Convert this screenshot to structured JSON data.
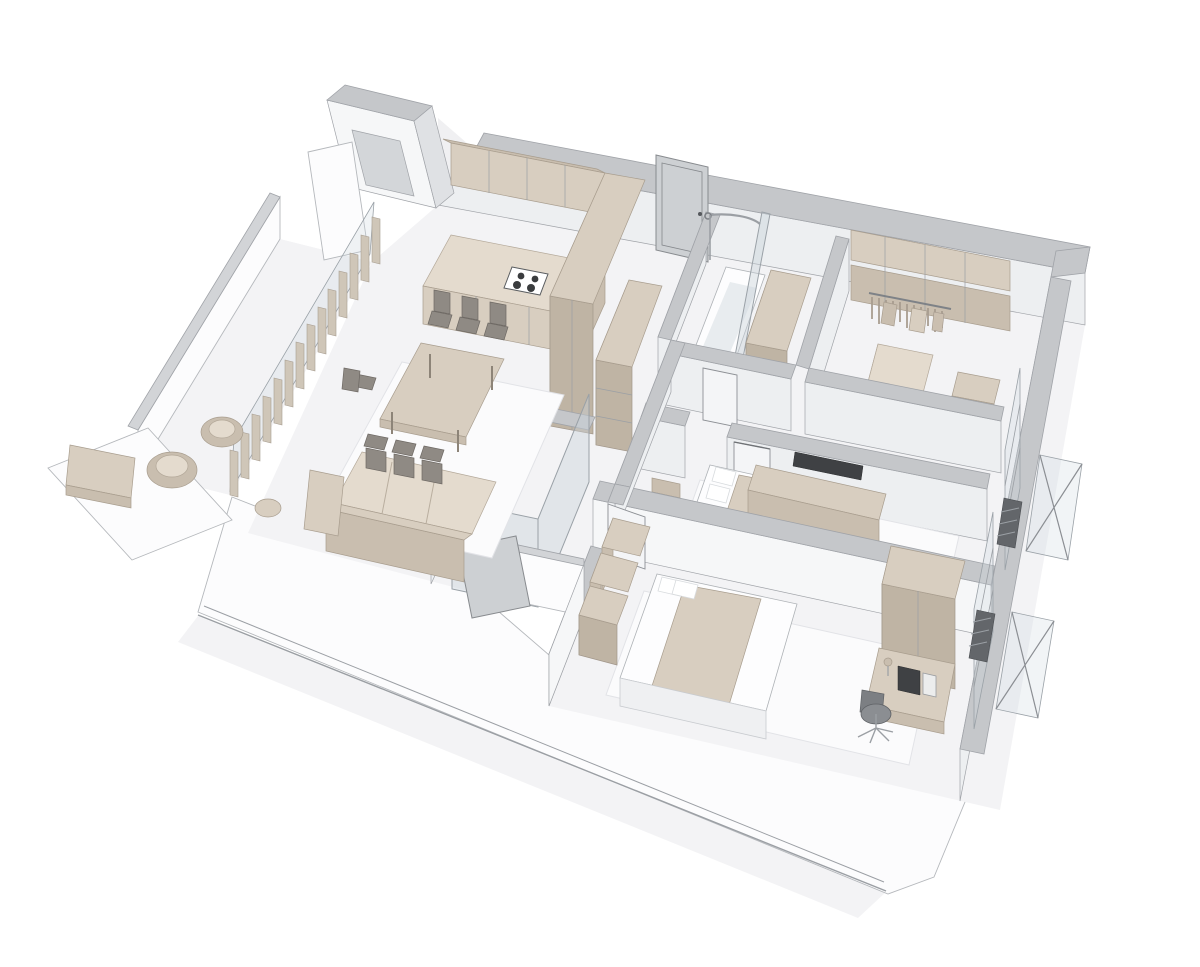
{
  "scene": {
    "description": "3D cutaway isometric rendering of a two-bedroom apartment floor plan, grayscale walls with beige furniture, no visible text",
    "type": "architectural-3d-floor-plan",
    "background": "#ffffff",
    "rooms": [
      {
        "name": "living-room",
        "furniture": [
          "corner-sofa",
          "dining-table",
          "six-dining-chairs",
          "side-table",
          "white-rug"
        ]
      },
      {
        "name": "kitchen",
        "furniture": [
          "l-shaped-counter",
          "cooktop-four-burners",
          "upper-cabinets",
          "tall-cabinet-column",
          "open-shelving-unit"
        ]
      },
      {
        "name": "balcony-left",
        "furniture": [
          "round-lounge-chair",
          "round-lounge-chair",
          "coffee-table",
          "vertical-slat-blinds",
          "glazing",
          "parapet-wall"
        ]
      },
      {
        "name": "entrance-hall",
        "furniture": [
          "tall-entrance-door",
          "open-vestibule-door",
          "corridor-walls"
        ]
      },
      {
        "name": "guest-wc",
        "furniture": [
          "glass-shower-enclosure",
          "toilet"
        ]
      },
      {
        "name": "bathroom",
        "furniture": [
          "bathtub",
          "curved-shower-rod",
          "glass-screen",
          "washer-storage-column",
          "white-door"
        ]
      },
      {
        "name": "walk-in-closet",
        "furniture": [
          "clothes-rail-with-hangers",
          "shelving-bands",
          "island-drawer-unit",
          "bench"
        ]
      },
      {
        "name": "bedroom-1",
        "furniture": [
          "double-bed",
          "pillows",
          "beige-blanket",
          "wall-tv",
          "tv-console",
          "armchair",
          "white-door",
          "white-rug"
        ]
      },
      {
        "name": "bedroom-2",
        "furniture": [
          "double-bed",
          "pillows",
          "beige-blanket",
          "wardrobe-cube-stack",
          "tall-wardrobe",
          "desk",
          "monitor",
          "desk-lamp",
          "task-chair",
          "white-door",
          "white-rug"
        ]
      },
      {
        "name": "right-facade",
        "furniture": [
          "window-bays",
          "radiators",
          "glass-balustrades",
          "strut-braces"
        ]
      }
    ],
    "palette": {
      "wall_top": "#c5c7ca",
      "wall_top_dark": "#d2d4d7",
      "wall_face": "#edeff1",
      "wall_face_bright": "#f6f7f8",
      "exterior_white": "#fcfcfd",
      "floor": "#f3f3f5",
      "rug": "#fbfbfc",
      "furniture_beige": "#d8cec0",
      "furniture_beige_dark": "#c9beaf",
      "furniture_beige_deep": "#bfb4a4",
      "furniture_beige_light": "#e4dbce",
      "glass_stroke": "#9aa1a7",
      "accent_dark": "#3f4144",
      "chair_gray": "#8f8a84",
      "edge": "#a0a3a8",
      "shadow": "#e9eaec"
    }
  }
}
